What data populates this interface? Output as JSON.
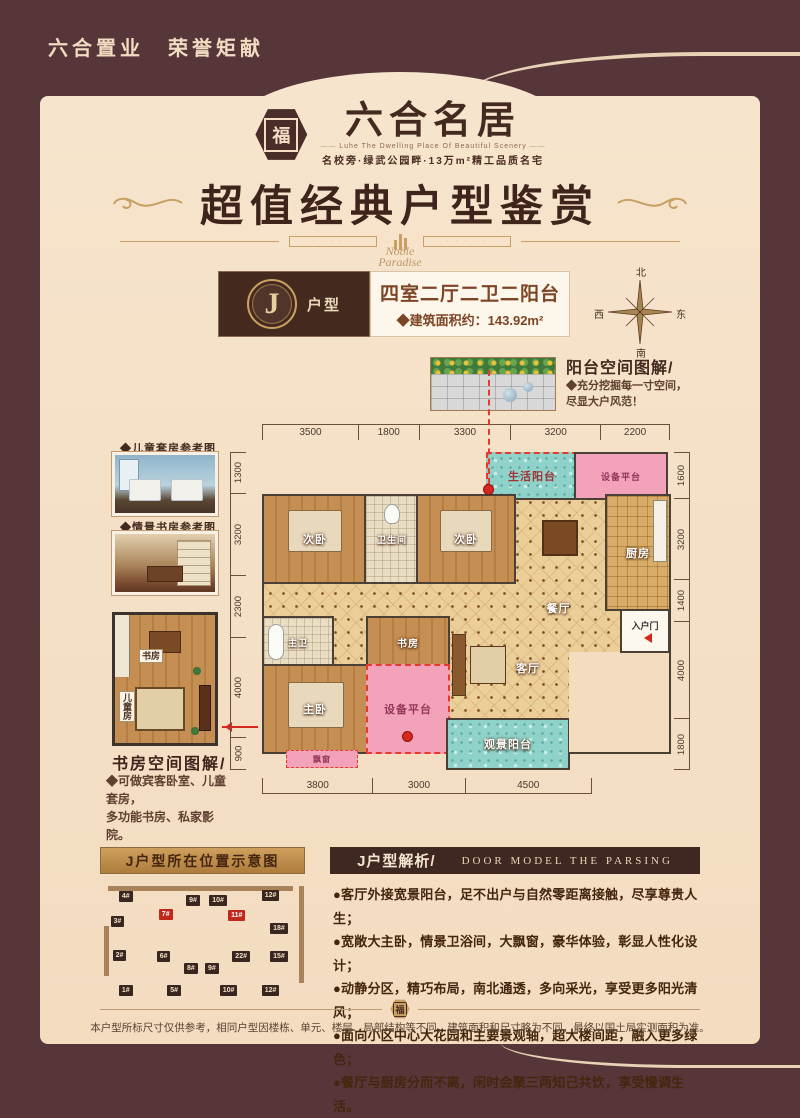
{
  "page": {
    "slogan": "六合置业　荣誉矩献",
    "disclaimer": "本户型所标尺寸仅供参考，相同户型因楼栋、单元、楼层、局部结构等不同，建筑面积和尺寸略为不同，最终以国土局实测面积为准。"
  },
  "logo": {
    "mark": "福",
    "name": "六合名居",
    "tagline_en": "Luhe The Dwelling Place Of Beautiful Scenery",
    "tagline_cn": "名校旁·绿武公园畔·13万m²精工品质名宅"
  },
  "title": {
    "main": "超值经典户型鉴赏",
    "script1": "Noble",
    "script2": "Paradise"
  },
  "unit": {
    "letter": "J",
    "suffix": "户型",
    "rooms": "四室二厅二卫二阳台",
    "area": "◆建筑面积约：143.92m²"
  },
  "compass": {
    "n": "北",
    "s": "南",
    "e": "东",
    "w": "西"
  },
  "balcony_note": {
    "title": "阳台空间图解/",
    "line1": "◆充分挖掘每一寸空间，",
    "line2": "尽显大户风范！"
  },
  "left_refs": {
    "photo1_label": "◆儿童套房参考图",
    "photo2_label": "◆情景书房参考图",
    "frag_study": "书房",
    "frag_kids": "儿童房",
    "caption": "书房空间图解/",
    "note1": "◆可做宾客卧室、儿童套房，",
    "note2": "多功能书房、私家影院。"
  },
  "floorplan": {
    "dims_top": [
      "3500",
      "1800",
      "3300",
      "3200",
      "2200"
    ],
    "dims_bottom": [
      "3800",
      "3000",
      "4500"
    ],
    "dims_left": [
      "1300",
      "3200",
      "2300",
      "4000",
      "900"
    ],
    "dims_right": [
      "1600",
      "3200",
      "1400",
      "4000",
      "1800"
    ],
    "rooms": {
      "living_balcony": "生活阳台",
      "equip_top": "设备平台",
      "bed2a": "次卧",
      "bath2": "卫生间",
      "bed2b": "次卧",
      "dining": "餐厅",
      "kitchen": "厨房",
      "entry": "入户门",
      "master_bath": "主卫",
      "master_bed": "主卧",
      "study": "书房",
      "equip_bottom": "设备平台",
      "living": "客厅",
      "view_balcony": "观景阳台",
      "bay": "飘窗"
    }
  },
  "bottom": {
    "left_bar": "J户型所在位置示意图",
    "right_bar_cn": "J户型解析/",
    "right_bar_en": "DOOR MODEL THE PARSING",
    "bullets": [
      "●客厅外接宽景阳台，足不出户与自然零距离接触，尽享尊贵人生；",
      "●宽敞大主卧，情景卫浴间，大飘窗，豪华体验，彰显人性化设计；",
      "●动静分区，精巧布局，南北通透，多向采光，享受更多阳光清风；",
      "●面向小区中心大花园和主要景观轴，超大楼间距，融入更多绿色；",
      "●餐厅与厨房分而不离，闲时会聚三两知己共饮，享受慢调生活。"
    ],
    "buildings": [
      {
        "label": "4#",
        "x": 9,
        "y": 6
      },
      {
        "label": "9#",
        "x": 41,
        "y": 9
      },
      {
        "label": "10#",
        "x": 52,
        "y": 9
      },
      {
        "label": "12#",
        "x": 77,
        "y": 5
      },
      {
        "label": "3#",
        "x": 5,
        "y": 27
      },
      {
        "label": "7#",
        "x": 28,
        "y": 21,
        "red": true
      },
      {
        "label": "11#",
        "x": 61,
        "y": 22,
        "red": true
      },
      {
        "label": "18#",
        "x": 81,
        "y": 33
      },
      {
        "label": "2#",
        "x": 6,
        "y": 56
      },
      {
        "label": "6#",
        "x": 27,
        "y": 57
      },
      {
        "label": "22#",
        "x": 63,
        "y": 57
      },
      {
        "label": "15#",
        "x": 81,
        "y": 57
      },
      {
        "label": "8#",
        "x": 40,
        "y": 67
      },
      {
        "label": "9#",
        "x": 50,
        "y": 67
      },
      {
        "label": "1#",
        "x": 9,
        "y": 86
      },
      {
        "label": "5#",
        "x": 32,
        "y": 86
      },
      {
        "label": "10#",
        "x": 57,
        "y": 86
      },
      {
        "label": "12#",
        "x": 77,
        "y": 86
      }
    ]
  },
  "colors": {
    "accent_red": "#e8392e",
    "teal": "#8fd2c9",
    "pink": "#f2a3b9",
    "gold": "#c9a063",
    "brown": "#4a2d28"
  }
}
